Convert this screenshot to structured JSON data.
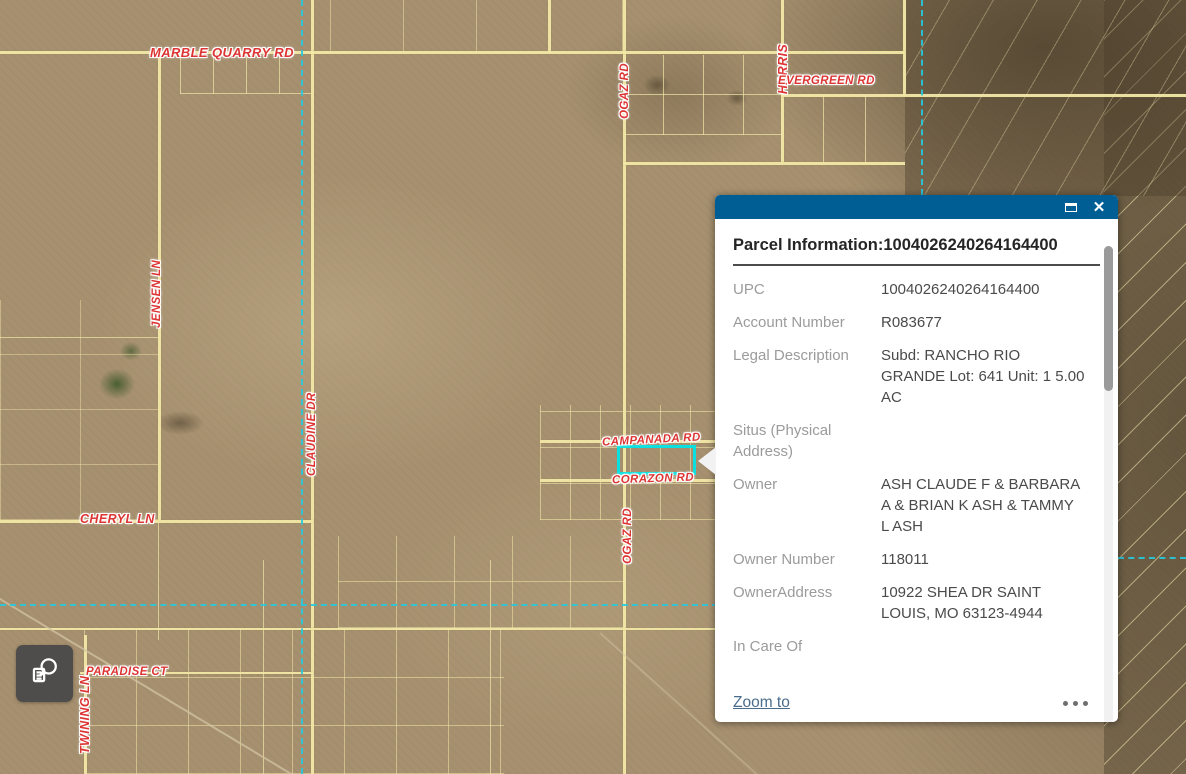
{
  "popup": {
    "title": "Parcel Information:1004026240264164400",
    "fields": [
      {
        "label": "UPC",
        "value": "1004026240264164400"
      },
      {
        "label": "Account Number",
        "value": "R083677"
      },
      {
        "label": "Legal Description",
        "value": "Subd: RANCHO RIO GRANDE Lot: 641 Unit: 1 5.00 AC"
      },
      {
        "label": "Situs (Physical Address)",
        "value": ""
      },
      {
        "label": "Owner",
        "value": "ASH CLAUDE F & BARBARA A & BRIAN K ASH & TAMMY L ASH"
      },
      {
        "label": "Owner Number",
        "value": "118011"
      },
      {
        "label": "OwnerAddress",
        "value": "10922 SHEA DR SAINT LOUIS, MO 63123-4944"
      },
      {
        "label": "In Care Of",
        "value": ""
      }
    ],
    "footer": {
      "zoom_to_label": "Zoom to"
    },
    "icons": {
      "maximize": "maximize-icon",
      "close": "close-icon",
      "more": "ellipsis-icon"
    }
  },
  "map": {
    "road_labels": [
      {
        "text": "MARBLE QUARRY RD"
      },
      {
        "text": "OGAZ RD"
      },
      {
        "text": "HARRIS"
      },
      {
        "text": "EVERGREEN RD"
      },
      {
        "text": "JENSEN LN"
      },
      {
        "text": "CLAUDINE DR"
      },
      {
        "text": "CAMPANADA RD"
      },
      {
        "text": "CORAZON RD"
      },
      {
        "text": "CHERYL LN"
      },
      {
        "text": "OGAZ RD"
      },
      {
        "text": "PARADISE CT"
      },
      {
        "text": "TWINING LN"
      }
    ]
  },
  "toolbar": {
    "search_button_icon": "attribute-search-icon"
  },
  "colors": {
    "popup_header": "#005e95",
    "road_label": "#dd3434",
    "parcel_highlight": "#0be0e0",
    "section_line": "#25cadf",
    "link": "#4a6d8c"
  }
}
